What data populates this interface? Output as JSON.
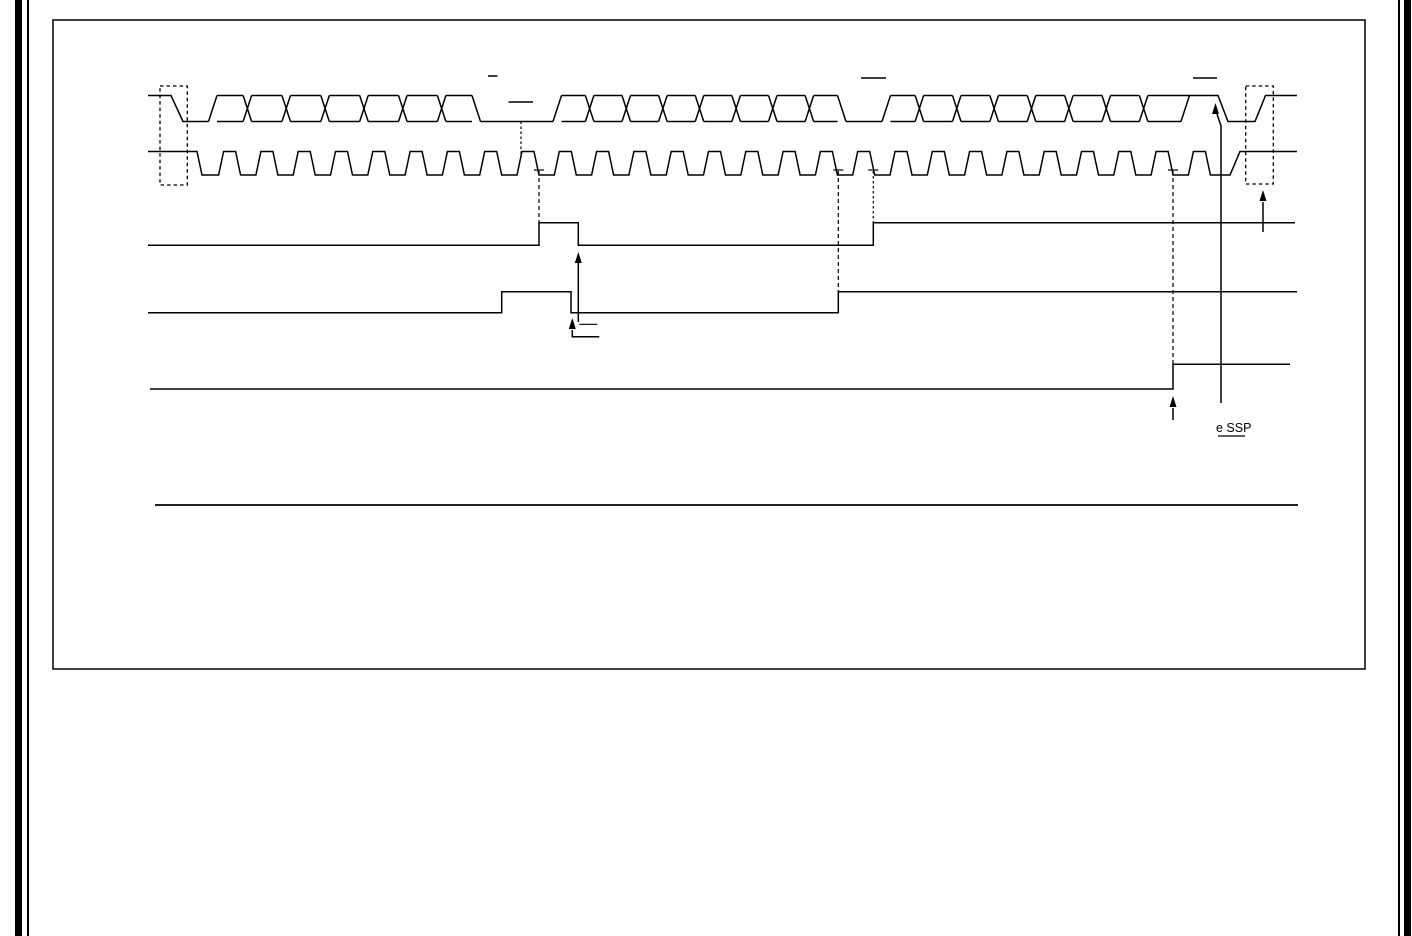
{
  "page": {
    "width": 1412,
    "height": 936,
    "background": "#ffffff",
    "ink": "#000000",
    "description": "datasheet-page-fragment-with-timing-diagram"
  },
  "diagram": {
    "ink": "#000000",
    "stroke_width": 1.5,
    "arrow_head": {
      "half_width": 3.5,
      "length": 11
    },
    "layers": [
      {
        "name": "page-side-borders",
        "prims": [
          {
            "t": "bar",
            "x": 15,
            "w": 7
          },
          {
            "t": "bar",
            "x": 27,
            "w": 2
          },
          {
            "t": "bar",
            "x": 1398,
            "w": 2
          },
          {
            "t": "bar",
            "x": 1404,
            "w": 7
          }
        ]
      },
      {
        "name": "figure-frame",
        "prims": [
          {
            "t": "rect",
            "x": 53,
            "y": 20,
            "width": 1312,
            "height": 649,
            "w": 1.5
          }
        ]
      },
      {
        "name": "sda-data-waveform",
        "prims": [
          {
            "t": "pl",
            "pts": [
              [
                148,
                95.5
              ],
              [
                171,
                95.5
              ],
              [
                183,
                121.5
              ],
              [
                208.5,
                121.5
              ]
            ]
          },
          {
            "t": "bus",
            "x0": 208.5,
            "x1": 480.5,
            "n": 7,
            "hi": 95.5,
            "lo": 121.5
          },
          {
            "t": "line",
            "x1": 480.5,
            "y1": 121.5,
            "x2": 553,
            "y2": 121.5
          },
          {
            "t": "bus",
            "x0": 553,
            "x1": 846,
            "n": 8,
            "hi": 95.5,
            "lo": 121.5
          },
          {
            "t": "line",
            "x1": 846,
            "y1": 121.5,
            "x2": 882,
            "y2": 121.5
          },
          {
            "t": "bus",
            "x0": 882,
            "x1": 1181,
            "n": 8,
            "hi": 95.5,
            "lo": 121.5,
            "open": true
          },
          {
            "t": "line",
            "x1": 1181,
            "y1": 121.5,
            "x2": 1189.5,
            "y2": 95.5
          },
          {
            "t": "pl",
            "pts": [
              [
                1181,
                95.5
              ],
              [
                1218,
                95.5
              ],
              [
                1228,
                121.5
              ],
              [
                1255,
                121.5
              ],
              [
                1265.5,
                95.5
              ],
              [
                1297,
                95.5
              ]
            ]
          }
        ]
      },
      {
        "name": "scl-clock-waveform",
        "prims": [
          {
            "t": "clock",
            "xs": 148,
            "hi": 151.5,
            "lo": 175,
            "fall_at": 197,
            "fall_w": 5,
            "r0": 218.6,
            "T": 37.3,
            "np": 27,
            "rw": 5,
            "tw": 12,
            "fw": 5,
            "tail_low_to": 1230,
            "tail_rise_w": 10,
            "xe": 1297
          }
        ]
      },
      {
        "name": "start-condition-box",
        "prims": [
          {
            "t": "rect",
            "x": 160,
            "y": 86,
            "width": 27.3,
            "height": 99,
            "dash": "3.5 3",
            "w": 1.3
          }
        ]
      },
      {
        "name": "stop-condition-box",
        "prims": [
          {
            "t": "rect",
            "x": 1245.7,
            "y": 86,
            "width": 27.6,
            "height": 98,
            "dash": "3.5 3",
            "w": 1.3
          }
        ]
      },
      {
        "name": "status-signal-1",
        "prims": [
          {
            "t": "pl",
            "pts": [
              [
                148,
                245.3
              ],
              [
                539,
                245.3
              ],
              [
                539,
                222.7
              ],
              [
                578.3,
                222.7
              ],
              [
                578.3,
                245.3
              ],
              [
                873.3,
                245.3
              ],
              [
                873.3,
                222.7
              ],
              [
                1295,
                222.7
              ]
            ]
          }
        ]
      },
      {
        "name": "status-signal-2",
        "prims": [
          {
            "t": "pl",
            "pts": [
              [
                148,
                312.7
              ],
              [
                501.7,
                312.7
              ],
              [
                501.7,
                291.7
              ],
              [
                571,
                291.7
              ],
              [
                571,
                312.7
              ],
              [
                838.3,
                312.7
              ],
              [
                838.3,
                291.7
              ],
              [
                1297,
                291.7
              ]
            ]
          }
        ]
      },
      {
        "name": "status-signal-3",
        "prims": [
          {
            "t": "pl",
            "pts": [
              [
                150,
                389
              ],
              [
                1173,
                389
              ],
              [
                1173,
                364.3
              ],
              [
                1290,
                364.3
              ]
            ]
          }
        ]
      },
      {
        "name": "overbar-marks",
        "prims": [
          {
            "t": "line",
            "x1": 488,
            "y1": 76,
            "x2": 497.5,
            "y2": 76
          },
          {
            "t": "line",
            "x1": 508.5,
            "y1": 102,
            "x2": 533,
            "y2": 102
          },
          {
            "t": "line",
            "x1": 861,
            "y1": 78,
            "x2": 886,
            "y2": 78
          },
          {
            "t": "line",
            "x1": 1193,
            "y1": 78,
            "x2": 1217,
            "y2": 78
          }
        ]
      },
      {
        "name": "reference-lines",
        "prims": [
          {
            "t": "line",
            "x1": 521,
            "y1": 121.5,
            "x2": 521,
            "y2": 154,
            "dash": "2.5 2.5",
            "w": 1.2
          },
          {
            "t": "line",
            "x1": 539,
            "y1": 171,
            "x2": 539,
            "y2": 222.7,
            "dash": "4 3",
            "w": 1.2
          },
          {
            "t": "line",
            "x1": 838.3,
            "y1": 171,
            "x2": 838.3,
            "y2": 291.7,
            "dash": "4 3",
            "w": 1.2
          },
          {
            "t": "line",
            "x1": 873.3,
            "y1": 171,
            "x2": 873.3,
            "y2": 222.7,
            "dash": "2.5 2.5",
            "w": 1.2
          },
          {
            "t": "line",
            "x1": 1173,
            "y1": 171,
            "x2": 1173,
            "y2": 364.3,
            "dash": "4 3",
            "w": 1.2
          },
          {
            "t": "line",
            "x1": 534,
            "y1": 170,
            "x2": 544,
            "y2": 170,
            "w": 1.2
          },
          {
            "t": "line",
            "x1": 833.3,
            "y1": 170,
            "x2": 843.3,
            "y2": 170,
            "w": 1.2
          },
          {
            "t": "line",
            "x1": 868.3,
            "y1": 170,
            "x2": 878.3,
            "y2": 170,
            "w": 1.2
          },
          {
            "t": "line",
            "x1": 1168,
            "y1": 170,
            "x2": 1178,
            "y2": 170,
            "w": 1.2
          }
        ]
      },
      {
        "name": "annotation-arrows",
        "prims": [
          {
            "t": "arrow",
            "shaft": [
              [
                578.3,
                322
              ],
              [
                578.3,
                255
              ]
            ],
            "tip": [
              578.3,
              252
            ]
          },
          {
            "t": "arrow",
            "shaft": [
              [
                599.3,
                336.7
              ],
              [
                572.3,
                336.7
              ],
              [
                572.3,
                330
              ]
            ],
            "tip": [
              572.3,
              318
            ]
          },
          {
            "t": "arrow",
            "shaft": [
              [
                1221,
                403
              ],
              [
                1221,
                126
              ],
              [
                1217,
                114
              ]
            ],
            "tip": [
              1215.5,
              103
            ]
          },
          {
            "t": "arrow",
            "shaft": [
              [
                1263,
                232
              ],
              [
                1263,
                202
              ]
            ],
            "tip": [
              1263,
              190
            ]
          },
          {
            "t": "arrow",
            "shaft": [
              [
                1173,
                420
              ],
              [
                1173,
                408
              ]
            ],
            "tip": [
              1173,
              396
            ]
          },
          {
            "t": "line",
            "x1": 579.3,
            "y1": 324.3,
            "x2": 597.3,
            "y2": 324.3,
            "w": 1.2
          }
        ]
      },
      {
        "name": "bottom-rule",
        "prims": [
          {
            "t": "line",
            "x1": 155,
            "y1": 505,
            "x2": 1298,
            "y2": 505,
            "w": 1.8
          }
        ]
      },
      {
        "name": "essp-label",
        "prims": [
          {
            "t": "text",
            "text": "e SSP",
            "x": 1216,
            "y": 432,
            "size": 12.5
          },
          {
            "t": "line",
            "x1": 1218,
            "y1": 436,
            "x2": 1245,
            "y2": 436,
            "w": 1.2
          }
        ]
      }
    ]
  },
  "labels": {
    "essp_text": "e SSP"
  }
}
